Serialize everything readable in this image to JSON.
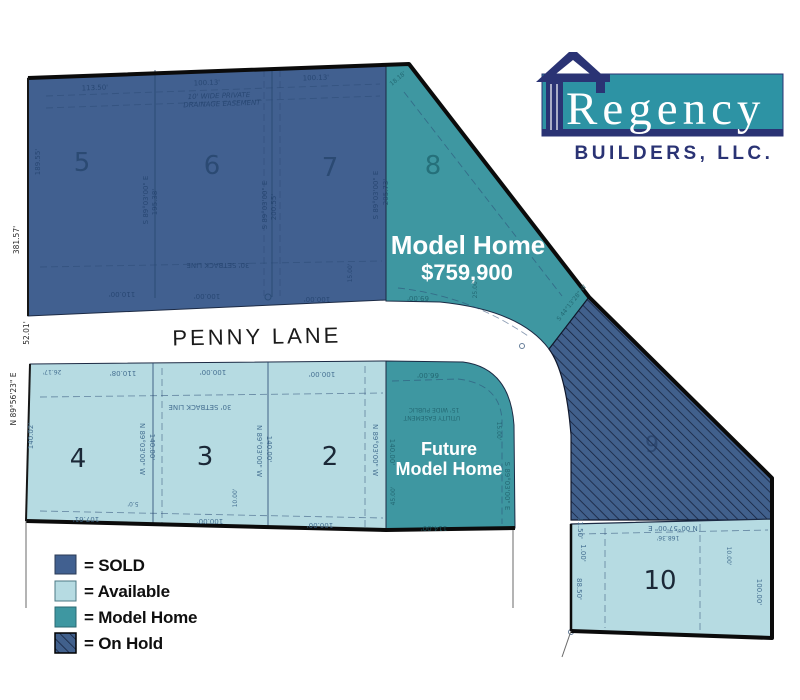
{
  "title": "Regency Builders lot availability site map",
  "logo": {
    "name": "Regency",
    "subtitle": "BUILDERS, LLC."
  },
  "street": {
    "name": "PENNY LANE"
  },
  "legend": {
    "items": [
      {
        "id": "sold",
        "label": "= SOLD",
        "color": "#416090",
        "hatched": false
      },
      {
        "id": "available",
        "label": "= Available",
        "color": "#b6dbe2",
        "hatched": false
      },
      {
        "id": "model-home",
        "label": "= Model Home",
        "color": "#3e97a1",
        "hatched": false
      },
      {
        "id": "on-hold",
        "label": "= On Hold",
        "color": "#41608c",
        "hatched": true
      }
    ]
  },
  "lots": {
    "lot2": {
      "number": "2",
      "status": "available"
    },
    "lot3": {
      "number": "3",
      "status": "available"
    },
    "lot4": {
      "number": "4",
      "status": "available"
    },
    "lot5": {
      "number": "5",
      "status": "sold"
    },
    "lot6": {
      "number": "6",
      "status": "sold"
    },
    "lot7": {
      "number": "7",
      "status": "sold"
    },
    "lot8": {
      "number": "8",
      "status": "model-home",
      "label": "Model Home",
      "price": "$759,900"
    },
    "lot9": {
      "number": "9",
      "status": "on-hold"
    },
    "lot10": {
      "number": "10",
      "status": "available"
    },
    "future_lot": {
      "status": "model-home",
      "label_line1": "Future",
      "label_line2": "Model Home"
    }
  },
  "survey": {
    "s1": "113.50'",
    "s2": "100.13'",
    "s3": "100.13'",
    "s4": "10' WIDE PRIVATE",
    "s5": "DRAINAGE EASEMENT",
    "s6": "18.18'",
    "s7": "189.55'",
    "s8": "S 89°03'00\" E",
    "s9": "195.38'",
    "s10": "S 89°03'00\" E",
    "s11": "200.55'",
    "s12": "S 89°03'00\" E",
    "s13": "205.73'",
    "s14": "30' SETBACK LINE",
    "s15": "110.00'",
    "s16": "100.00'",
    "s17": "100.00'",
    "s18": "15.00'",
    "s19": "381.57'",
    "s20": "52.01'",
    "s21": "N 89°56'23\" E",
    "s22": "140.02'",
    "s23": "26.17'",
    "s24": "110.08'",
    "s25": "100.00'",
    "s26": "100.00'",
    "s27": "30' SETBACK LINE",
    "s28": "N 89°03'00\" W",
    "s29": "140.00'",
    "s30": "N 89°03'00\" W",
    "s31": "140.00'",
    "s32": "N 89°03'00\" W",
    "s33": "140.00'",
    "s34": "107.61'",
    "s35": "5.0'",
    "s36": "100.00'",
    "s37": "100.00'",
    "s38": "10.00'",
    "s39": "66.00'",
    "s40": "15' WIDE PUBLIC",
    "s41": "UTILITY EASEMENT",
    "s42": "S 89°03'00\" E",
    "s43": "15.00'",
    "s44": "45.00'",
    "s45": "114.00'",
    "s46": "69.00'",
    "s47": "25.00'",
    "s48": "S 44°13'28\" W",
    "s49": "N 00°57'00\" E",
    "s50": "168.36'",
    "s51": "11.50'",
    "s52": "1.00'",
    "s53": "88.50'",
    "s54": "10.00'",
    "s55": "100.00'"
  },
  "colors": {
    "sold": "#416090",
    "available": "#b6dbe2",
    "model_home": "#3e97a1",
    "on_hold_base": "#41608c",
    "hatch_line": "#141f3a",
    "boundary": "#0b0b0b",
    "logo_navy": "#2a3374",
    "logo_teal": "#2d93a4"
  }
}
